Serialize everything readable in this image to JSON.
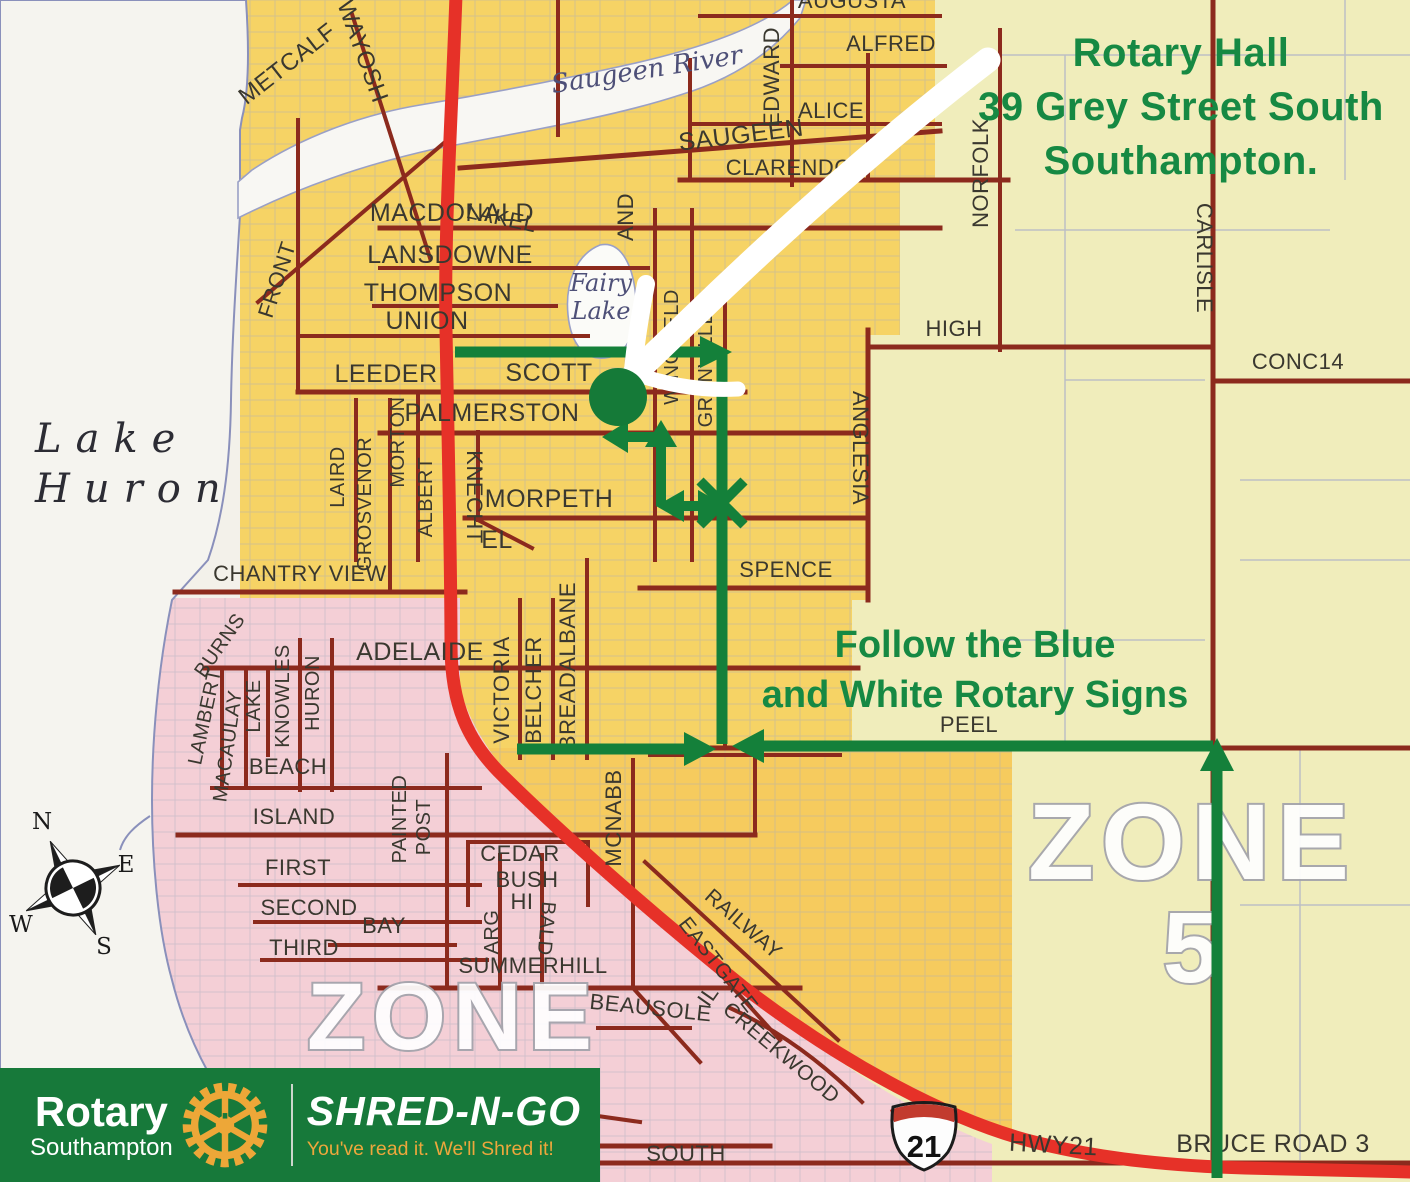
{
  "colors": {
    "annotation_green": "#168943",
    "route_green": "#14803a",
    "banner_green": "#17793a",
    "rotary_gold": "#eda738",
    "map_yellow": "#f6d365",
    "map_pale_yellow": "#f0edbb",
    "map_pink": "#f4cfd6",
    "highway_red": "#e63128",
    "road_maroon": "#8c2a1d"
  },
  "annotations": {
    "hall": {
      "line1": "Rotary Hall",
      "line2": "39 Grey Street South",
      "line3": "Southampton."
    },
    "signs": {
      "line1": "Follow the Blue",
      "line2": "and White Rotary Signs"
    }
  },
  "banner": {
    "org": "Rotary",
    "club": "Southampton",
    "brand": "SHRED-N-GO",
    "tagline": "You've read it. We'll Shred it!"
  },
  "map": {
    "shield_number": "21",
    "lake_label": {
      "line1": "Lake",
      "line2": "Huron"
    },
    "compass": {
      "n": "N",
      "e": "E",
      "w": "W",
      "s": "S"
    },
    "zone_labels": [
      {
        "t": "ZONE",
        "x": 453,
        "y": 1049,
        "s": 95
      },
      {
        "t": "ZONE",
        "x": 1192,
        "y": 879,
        "s": 108
      },
      {
        "t": "5",
        "x": 1194,
        "y": 982,
        "s": 100
      }
    ],
    "water_labels": [
      {
        "t": "Saugeen River",
        "x": 648,
        "y": 78,
        "r": -9,
        "s": 26
      },
      {
        "t": "Fairy",
        "x": 601,
        "y": 291,
        "r": 0,
        "s": 24
      },
      {
        "t": "Lake",
        "x": 601,
        "y": 319,
        "r": 0,
        "s": 24
      }
    ],
    "street_labels": [
      {
        "t": "METCALF",
        "x": 292,
        "y": 70,
        "r": -38,
        "s": 24
      },
      {
        "t": "OWAYOSH",
        "x": 352,
        "y": 45,
        "r": 70,
        "s": 24
      },
      {
        "t": "SAUGEEN",
        "x": 742,
        "y": 143,
        "r": -7,
        "s": 25
      },
      {
        "t": "MACDONALD",
        "x": 452,
        "y": 221,
        "s": 25
      },
      {
        "t": "LANSDOWNE",
        "x": 450,
        "y": 263,
        "s": 25
      },
      {
        "t": "THOMPSON",
        "x": 438,
        "y": 301,
        "s": 25
      },
      {
        "t": "UNION",
        "x": 427,
        "y": 329,
        "s": 25
      },
      {
        "t": "LEEDER",
        "x": 386,
        "y": 382,
        "s": 25
      },
      {
        "t": "SCOTT",
        "x": 549,
        "y": 381,
        "s": 25
      },
      {
        "t": "PALMERSTON",
        "x": 492,
        "y": 421,
        "s": 25
      },
      {
        "t": "MORPETH",
        "x": 549,
        "y": 507,
        "s": 25
      },
      {
        "t": "EL",
        "x": 497,
        "y": 548,
        "s": 25
      },
      {
        "t": "KNECHT",
        "x": 467,
        "y": 497,
        "r": 90,
        "s": 22
      },
      {
        "t": "CHANTRY VIEW",
        "x": 300,
        "y": 581,
        "s": 22
      },
      {
        "t": "ADELAIDE",
        "x": 420,
        "y": 660,
        "s": 25
      },
      {
        "t": "BEACH",
        "x": 288,
        "y": 774,
        "s": 22
      },
      {
        "t": "ISLAND",
        "x": 294,
        "y": 824,
        "s": 22
      },
      {
        "t": "FIRST",
        "x": 298,
        "y": 875,
        "s": 22
      },
      {
        "t": "SECOND",
        "x": 309,
        "y": 915,
        "s": 22
      },
      {
        "t": "THIRD",
        "x": 304,
        "y": 955,
        "s": 22
      },
      {
        "t": "BAY",
        "x": 384,
        "y": 933,
        "s": 22
      },
      {
        "t": "SUMMERHILL",
        "x": 533,
        "y": 973,
        "s": 22
      },
      {
        "t": "CEDAR",
        "x": 520,
        "y": 861,
        "s": 22
      },
      {
        "t": "BUSH",
        "x": 527,
        "y": 887,
        "s": 22
      },
      {
        "t": "HI",
        "x": 522,
        "y": 909,
        "s": 22
      },
      {
        "t": "ARG",
        "x": 498,
        "y": 932,
        "r": -90,
        "s": 20
      },
      {
        "t": "BALD",
        "x": 540,
        "y": 928,
        "r": 95,
        "s": 20
      },
      {
        "t": "BEAUSOLE",
        "x": 650,
        "y": 1015,
        "r": 6,
        "s": 22
      },
      {
        "t": "IL",
        "x": 714,
        "y": 1000,
        "r": -55,
        "s": 22
      },
      {
        "t": "LAKESIDE",
        "x": 406,
        "y": 1095,
        "r": 13,
        "s": 22
      },
      {
        "t": "MEADOW",
        "x": 531,
        "y": 1104,
        "r": 15,
        "s": 22
      },
      {
        "t": "SOUTH",
        "x": 686,
        "y": 1161,
        "s": 22
      },
      {
        "t": "RAILWAY",
        "x": 739,
        "y": 929,
        "r": 41,
        "s": 21
      },
      {
        "t": "EASTGATE",
        "x": 713,
        "y": 969,
        "r": 52,
        "s": 21
      },
      {
        "t": "CREEKWOOD",
        "x": 777,
        "y": 1058,
        "r": 40,
        "s": 21
      },
      {
        "t": "MCNABB",
        "x": 621,
        "y": 818,
        "r": -90,
        "s": 22
      },
      {
        "t": "VICTORIA",
        "x": 509,
        "y": 690,
        "r": -90,
        "s": 22
      },
      {
        "t": "BELCHER",
        "x": 541,
        "y": 690,
        "r": -90,
        "s": 22
      },
      {
        "t": "BREADALBANE",
        "x": 575,
        "y": 666,
        "r": -90,
        "s": 22
      },
      {
        "t": "LAKE",
        "x": 260,
        "y": 706,
        "r": -90,
        "s": 20
      },
      {
        "t": "KNOWLES",
        "x": 289,
        "y": 696,
        "r": -90,
        "s": 20
      },
      {
        "t": "HURON",
        "x": 319,
        "y": 693,
        "r": -90,
        "s": 20
      },
      {
        "t": "LAMBERT",
        "x": 211,
        "y": 718,
        "r": -78,
        "s": 20
      },
      {
        "t": "MACAULAY",
        "x": 234,
        "y": 747,
        "r": -82,
        "s": 20
      },
      {
        "t": "BURNS",
        "x": 225,
        "y": 649,
        "r": -55,
        "s": 20
      },
      {
        "t": "PAINTED",
        "x": 406,
        "y": 819,
        "r": -90,
        "s": 20
      },
      {
        "t": "POST",
        "x": 430,
        "y": 827,
        "r": -90,
        "s": 20
      },
      {
        "t": "FRONT",
        "x": 284,
        "y": 282,
        "r": -72,
        "s": 22
      },
      {
        "t": "LAIRD",
        "x": 344,
        "y": 477,
        "r": -90,
        "s": 20
      },
      {
        "t": "GROSVENOR",
        "x": 371,
        "y": 504,
        "r": -90,
        "s": 20
      },
      {
        "t": "MORTON",
        "x": 404,
        "y": 442,
        "r": -90,
        "s": 20
      },
      {
        "t": "ALBERT",
        "x": 432,
        "y": 497,
        "r": -90,
        "s": 20
      },
      {
        "t": "WINGFIELD",
        "x": 678,
        "y": 347,
        "r": -90,
        "s": 20
      },
      {
        "t": "GRENVILLE",
        "x": 712,
        "y": 369,
        "r": -90,
        "s": 20
      },
      {
        "t": "ANGLESIA",
        "x": 853,
        "y": 448,
        "r": 90,
        "s": 22
      },
      {
        "t": "EDWARD",
        "x": 779,
        "y": 77,
        "r": -90,
        "s": 22
      },
      {
        "t": "NORFOLK",
        "x": 988,
        "y": 173,
        "r": -90,
        "s": 22
      },
      {
        "t": "CARLISLE",
        "x": 1197,
        "y": 258,
        "r": 90,
        "s": 22
      },
      {
        "t": "HIGH",
        "x": 954,
        "y": 336,
        "s": 22
      },
      {
        "t": "CONC14",
        "x": 1298,
        "y": 369,
        "s": 22
      },
      {
        "t": "SPENCE",
        "x": 786,
        "y": 577,
        "s": 22
      },
      {
        "t": "PEEL",
        "x": 969,
        "y": 732,
        "s": 22
      },
      {
        "t": "ALFRED",
        "x": 891,
        "y": 51,
        "s": 22
      },
      {
        "t": "ALICE",
        "x": 831,
        "y": 118,
        "s": 22
      },
      {
        "t": "CLARENDON",
        "x": 797,
        "y": 175,
        "s": 22
      },
      {
        "t": "AUGUSTA",
        "x": 852,
        "y": 8,
        "s": 22
      },
      {
        "t": "LAKEL",
        "x": 500,
        "y": 225,
        "r": 12,
        "s": 22
      },
      {
        "t": "AND",
        "x": 633,
        "y": 217,
        "r": -90,
        "s": 22
      },
      {
        "t": "HWY21",
        "x": 1053,
        "y": 1153,
        "r": 3,
        "s": 25
      },
      {
        "t": "BRUCE ROAD 3",
        "x": 1273,
        "y": 1152,
        "s": 25
      }
    ]
  }
}
